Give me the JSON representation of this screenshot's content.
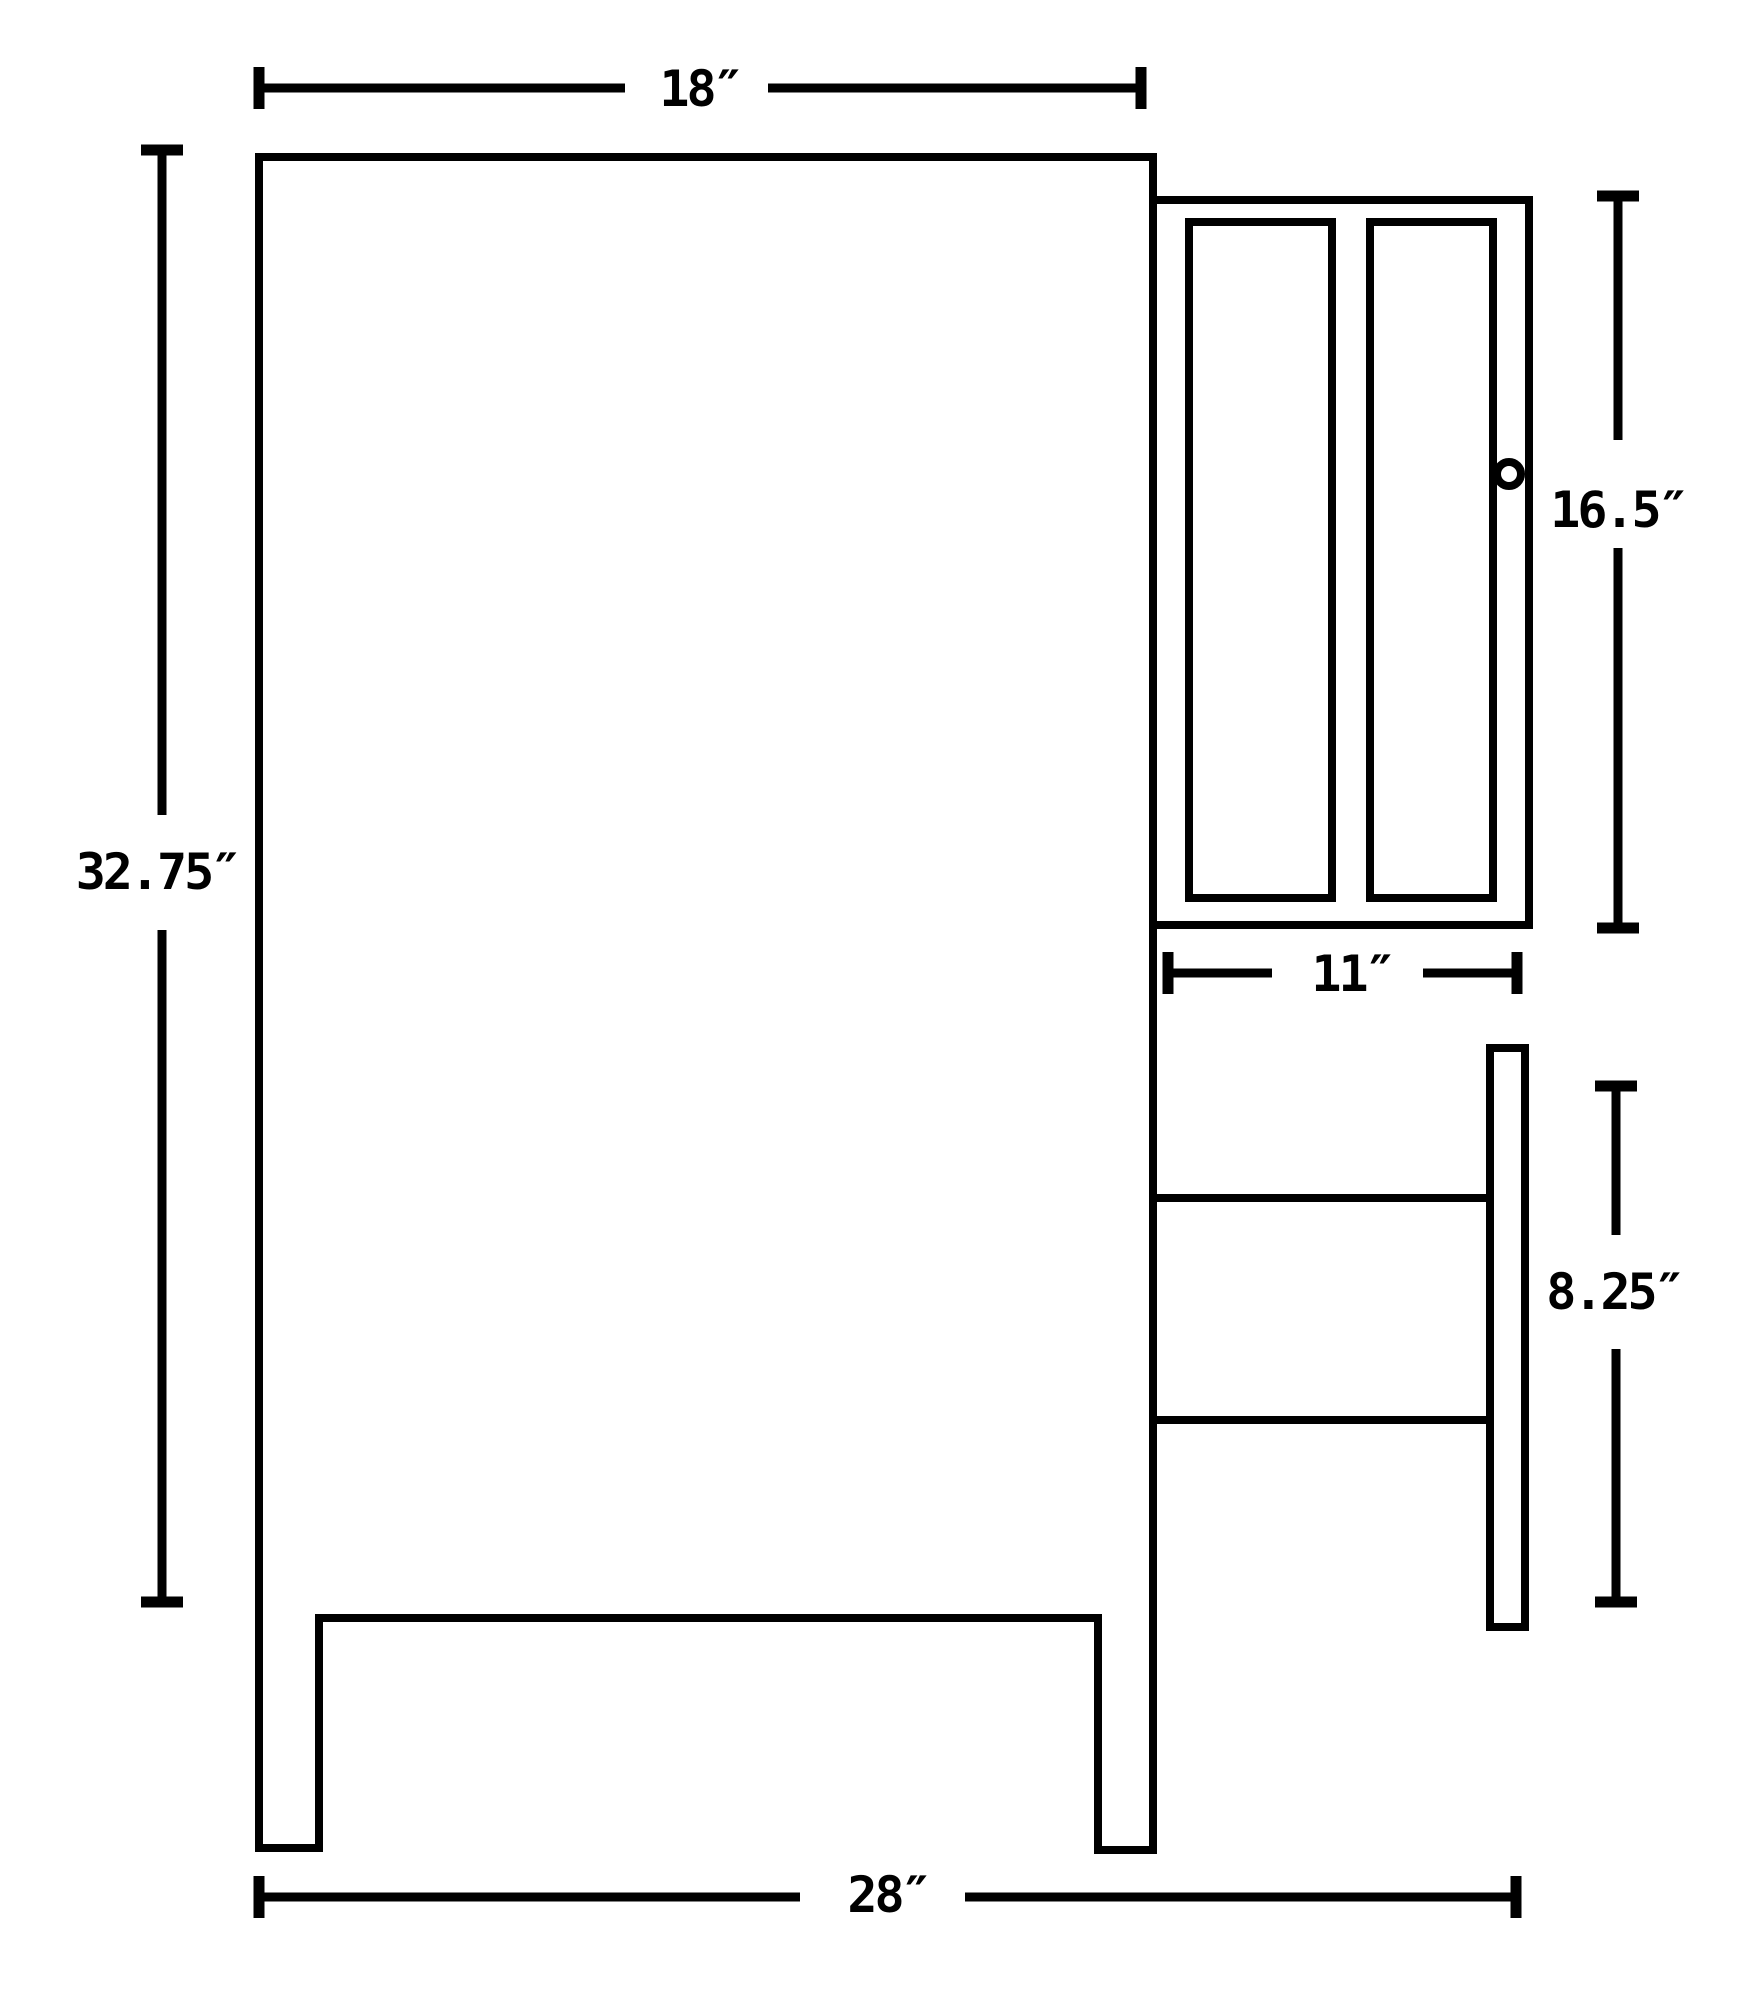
{
  "diagram": {
    "type": "technical line drawing",
    "subject": "bathroom vanity cabinet side elevation with medicine cabinet and drawer bank",
    "colors": {
      "line": "#000000",
      "background": "#ffffff"
    },
    "dimensions": {
      "top_width": {
        "label": "18″",
        "value": 18,
        "unit": "inches"
      },
      "overall_height": {
        "label": "32.75″",
        "value": 32.75,
        "unit": "inches"
      },
      "cabinet_height": {
        "label": "16.5″",
        "value": 16.5,
        "unit": "inches"
      },
      "cabinet_width": {
        "label": "11″",
        "value": 11,
        "unit": "inches"
      },
      "drawer_stack_height": {
        "label": "8.25″",
        "value": 8.25,
        "unit": "inches"
      },
      "overall_width": {
        "label": "28″",
        "value": 28,
        "unit": "inches"
      }
    }
  }
}
